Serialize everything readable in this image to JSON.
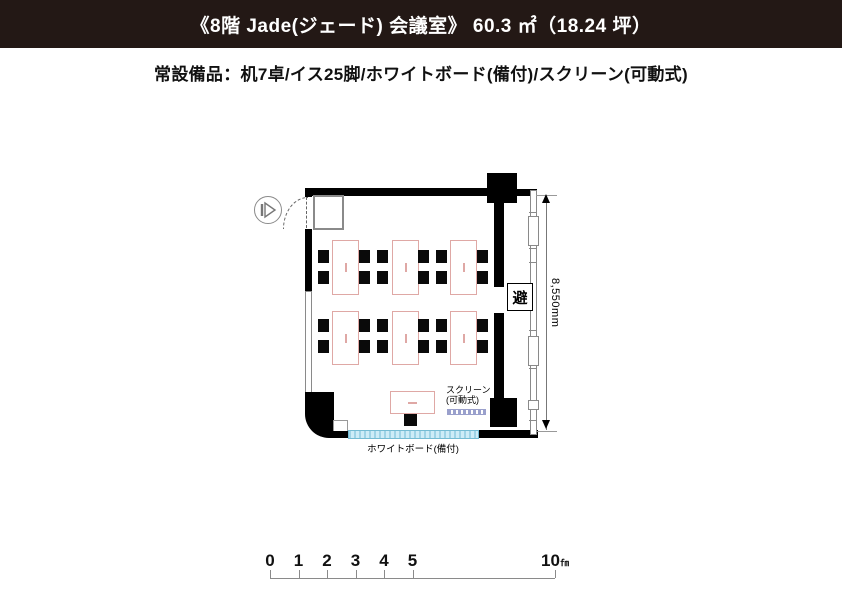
{
  "header": {
    "title": "《8階 Jade(ジェード) 会議室》 60.3 ㎡（18.24 坪）",
    "bg_color": "#231815",
    "text_color": "#ffffff"
  },
  "equipment_line": "常設備品：机7卓/イス25脚/ホワイトボード(備付)/スクリーン(可動式)",
  "floorplan": {
    "labels": {
      "escape_sign": "避",
      "dimension": "8,550mm",
      "screen_line1": "スクリーン",
      "screen_line2": "(可動式)",
      "whiteboard": "ホワイトボード(備付)"
    },
    "colors": {
      "wall": "#000000",
      "table_outline": "#dfa8a5",
      "whiteboard_fill": "#cdecf7",
      "whiteboard_border": "#74bcd4",
      "screen_dash": "#9aa0cc"
    },
    "tables": [
      {
        "x": 332,
        "y": 240,
        "w": 25,
        "h": 53,
        "orient": "v"
      },
      {
        "x": 392,
        "y": 240,
        "w": 25,
        "h": 53,
        "orient": "v"
      },
      {
        "x": 450,
        "y": 240,
        "w": 25,
        "h": 53,
        "orient": "v"
      },
      {
        "x": 332,
        "y": 311,
        "w": 25,
        "h": 52,
        "orient": "v"
      },
      {
        "x": 392,
        "y": 311,
        "w": 25,
        "h": 52,
        "orient": "v"
      },
      {
        "x": 450,
        "y": 311,
        "w": 25,
        "h": 52,
        "orient": "v"
      },
      {
        "x": 390,
        "y": 391,
        "w": 43,
        "h": 21,
        "orient": "h"
      }
    ],
    "chairs": [
      {
        "x": 318,
        "y": 250
      },
      {
        "x": 359,
        "y": 250
      },
      {
        "x": 377,
        "y": 250
      },
      {
        "x": 418,
        "y": 250
      },
      {
        "x": 436,
        "y": 250
      },
      {
        "x": 477,
        "y": 250
      },
      {
        "x": 318,
        "y": 271
      },
      {
        "x": 359,
        "y": 271
      },
      {
        "x": 377,
        "y": 271
      },
      {
        "x": 418,
        "y": 271
      },
      {
        "x": 436,
        "y": 271
      },
      {
        "x": 477,
        "y": 271
      },
      {
        "x": 318,
        "y": 319
      },
      {
        "x": 359,
        "y": 319
      },
      {
        "x": 377,
        "y": 319
      },
      {
        "x": 418,
        "y": 319
      },
      {
        "x": 436,
        "y": 319
      },
      {
        "x": 477,
        "y": 319
      },
      {
        "x": 318,
        "y": 340
      },
      {
        "x": 359,
        "y": 340
      },
      {
        "x": 377,
        "y": 340
      },
      {
        "x": 418,
        "y": 340
      },
      {
        "x": 436,
        "y": 340
      },
      {
        "x": 477,
        "y": 340
      },
      {
        "x": 404,
        "y": 414,
        "w": 13,
        "h": 12
      }
    ]
  },
  "scalebar": {
    "origin_x": 270,
    "pixels_per_meter": 28.5,
    "marks": [
      {
        "m": 0,
        "label": "0"
      },
      {
        "m": 1,
        "label": "1"
      },
      {
        "m": 2,
        "label": "2"
      },
      {
        "m": 3,
        "label": "3"
      },
      {
        "m": 4,
        "label": "4"
      },
      {
        "m": 5,
        "label": "5"
      },
      {
        "m": 10,
        "label": "10",
        "unit": "㎙"
      }
    ]
  }
}
